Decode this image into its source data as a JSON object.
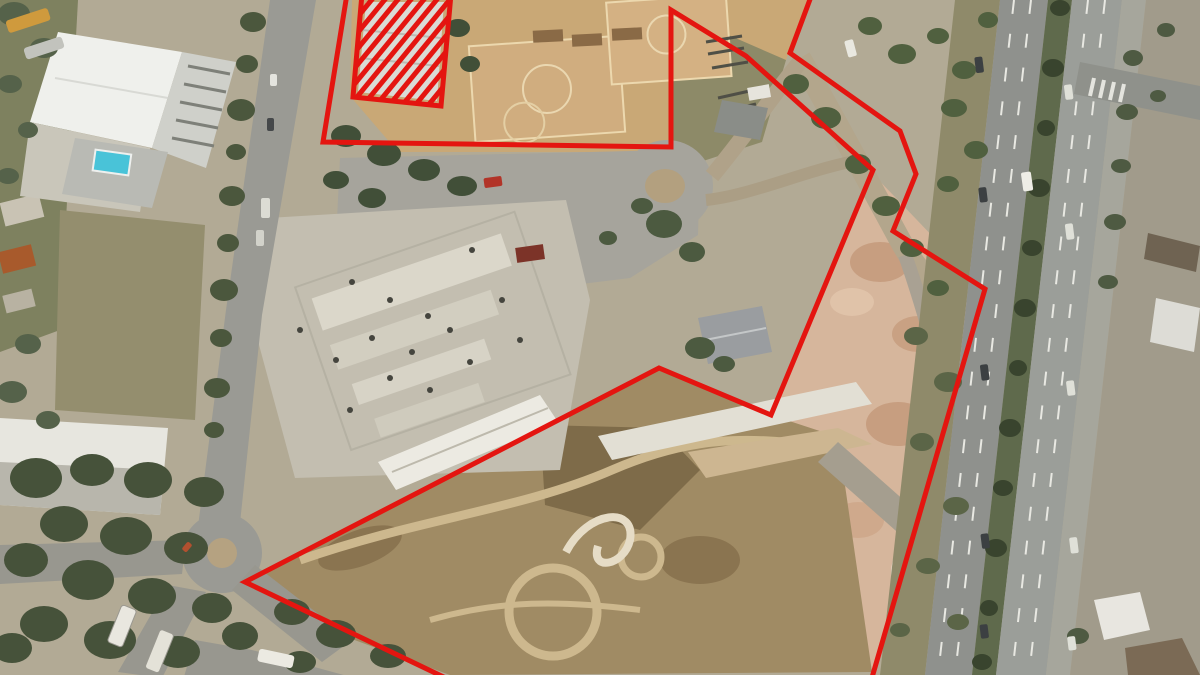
{
  "image": {
    "kind": "aerial-drone-photograph-with-site-annotation",
    "width": 1200,
    "height": 675
  },
  "annotation": {
    "color": "#e41510",
    "stroke_width": 5,
    "site_boundary_points": "347,-6 323,142 671,147 671,10 746,56 873,170 771,415 659,368 245,582 452,681 871,681 985,289 893,231 916,174 900,131 790,53 812,-6",
    "hatched_area": {
      "outline_points": "362,-6 353,97 441,106 451,-6",
      "stripe_spacing": 13,
      "stripe_dx": 105,
      "stripe_dy": -128,
      "stripe_width": 5,
      "x_start": 252,
      "x_end": 468,
      "base_y": 114
    }
  },
  "palette": {
    "ground_base": "#b2aa95",
    "dirt_field": "#c9a876",
    "court_light": "#d2b084",
    "pink_field": "#d6b69c",
    "lower_field": "#a08b64",
    "asphalt": "#a6a49c",
    "concrete_pad": "#c3beb0",
    "road_grey": "#9a9a94",
    "highway_left": "#8f918d",
    "highway_right": "#9b9e99",
    "median_green": "#5f6a4c",
    "verge_scrub": "#8f8a6a",
    "tree_dark": "#46523a",
    "roof_white": "#eff0ec",
    "pool_blue": "#49c3d8"
  },
  "scene": {
    "description": "Aerial photograph of a large redevelopment site outlined in red, with a hatched exclusion building top-left",
    "features": [
      "sports-hall with swimming pool (top left)",
      "dirt sports courts (top centre)",
      "construction site with concrete slabs (centre)",
      "cleared pink earth field (right)",
      "scrub field with circular tracks (bottom)",
      "local road with roundabout (left)",
      "multi-lane highway with tree median (right)",
      "tree clusters and parked buses"
    ]
  }
}
